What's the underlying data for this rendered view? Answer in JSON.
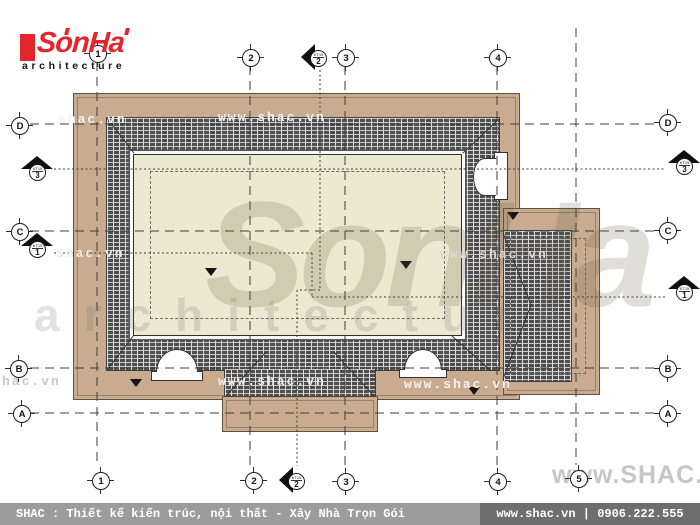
{
  "logo": {
    "brand": "SonHa",
    "tagline": "architecture"
  },
  "footer": {
    "left": "SHAC : Thiết kế kiến trúc, nội thất - Xây Nhà Trọn Gói",
    "right": "www.shac.vn | 0906.222.555"
  },
  "watermark": {
    "brand_large": "SonHa",
    "architecture": "architecture",
    "site_outline": "www.SHAC.vn",
    "tags": [
      "shac.vn",
      "www.shac.vn",
      "shac.vn",
      "www.shac.vn",
      "hac.vn",
      "www.shac.vn",
      "www.shac.vn"
    ]
  },
  "grid": {
    "top": [
      "1",
      "2",
      "3",
      "4"
    ],
    "bottom": [
      "1",
      "2",
      "3",
      "4",
      "5"
    ],
    "left": [
      "D",
      "C",
      "B",
      "A"
    ],
    "right": [
      "D",
      "C",
      "B",
      "A"
    ]
  },
  "sections": {
    "top2": {
      "ref": "KT15",
      "num": "2"
    },
    "bottom2": {
      "ref": "KT15",
      "num": "2"
    },
    "left3": {
      "ref": "KT15",
      "num": "3"
    },
    "right3": {
      "ref": "KT15",
      "num": "3"
    },
    "left1": {
      "ref": "KT15",
      "num": "1"
    },
    "right1": {
      "ref": "KT15",
      "num": "1"
    }
  },
  "colors": {
    "roof_eave_tan": "#c9ac90",
    "roof_flat_cream": "#ece9d0",
    "tile_hatch_dark": "#4e4e4e",
    "logo_red": "#e4252b",
    "footer_left_bg": "#9c9c9c",
    "footer_right_bg": "#6e6e6e"
  }
}
